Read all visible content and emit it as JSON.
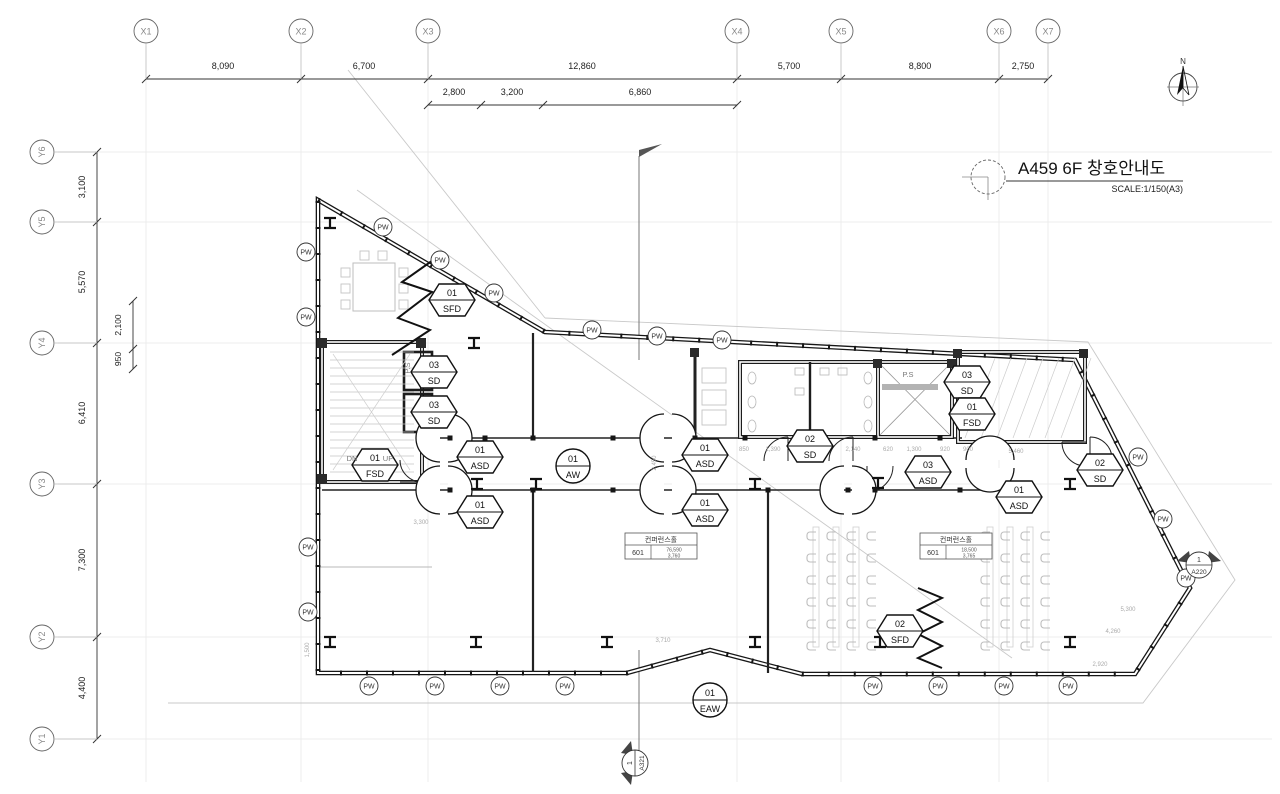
{
  "title": {
    "text": "A459 6F 창호안내도",
    "scale": "SCALE:1/150(A3)"
  },
  "north": {
    "label": "N"
  },
  "grid": {
    "x_markers": [
      {
        "label": "X1",
        "x": 146
      },
      {
        "label": "X2",
        "x": 301
      },
      {
        "label": "X3",
        "x": 428
      },
      {
        "label": "X4",
        "x": 737
      },
      {
        "label": "X5",
        "x": 841
      },
      {
        "label": "X6",
        "x": 999
      },
      {
        "label": "X7",
        "x": 1048
      }
    ],
    "x_dims": [
      {
        "label": "8,090",
        "x": 223
      },
      {
        "label": "6,700",
        "x": 364
      },
      {
        "label": "12,860",
        "x": 582
      },
      {
        "label": "5,700",
        "x": 789
      },
      {
        "label": "8,800",
        "x": 920
      },
      {
        "label": "2,750",
        "x": 1023
      }
    ],
    "x_subdims": [
      {
        "label": "2,800",
        "x": 454
      },
      {
        "label": "3,200",
        "x": 512
      },
      {
        "label": "6,860",
        "x": 640
      }
    ],
    "x_subticks": [
      428,
      481,
      543,
      737
    ],
    "y_markers": [
      {
        "label": "Y6",
        "y": 152
      },
      {
        "label": "Y5",
        "y": 222
      },
      {
        "label": "Y4",
        "y": 343
      },
      {
        "label": "Y3",
        "y": 484
      },
      {
        "label": "Y2",
        "y": 637
      },
      {
        "label": "Y1",
        "y": 739
      }
    ],
    "y_dims": [
      {
        "label": "3,100",
        "y": 187
      },
      {
        "label": "5,570",
        "y": 282
      },
      {
        "label": "6,410",
        "y": 413
      },
      {
        "label": "7,300",
        "y": 560
      },
      {
        "label": "4,400",
        "y": 688
      }
    ],
    "y_subdims": [
      {
        "label": "2,100",
        "y": 325
      },
      {
        "label": "950",
        "y": 359
      }
    ],
    "y_subticks": [
      301,
      349,
      369
    ]
  },
  "hex_tags": [
    {
      "num": "01",
      "code": "SFD",
      "x": 452,
      "y": 300
    },
    {
      "num": "03",
      "code": "SD",
      "x": 434,
      "y": 372
    },
    {
      "num": "03",
      "code": "SD",
      "x": 434,
      "y": 412
    },
    {
      "num": "01",
      "code": "FSD",
      "x": 375,
      "y": 465
    },
    {
      "num": "01",
      "code": "ASD",
      "x": 480,
      "y": 457
    },
    {
      "num": "01",
      "code": "ASD",
      "x": 480,
      "y": 512
    },
    {
      "num": "01",
      "code": "ASD",
      "x": 705,
      "y": 455
    },
    {
      "num": "01",
      "code": "ASD",
      "x": 705,
      "y": 510
    },
    {
      "num": "02",
      "code": "SD",
      "x": 810,
      "y": 446
    },
    {
      "num": "03",
      "code": "ASD",
      "x": 928,
      "y": 472
    },
    {
      "num": "03",
      "code": "SD",
      "x": 967,
      "y": 382
    },
    {
      "num": "01",
      "code": "FSD",
      "x": 972,
      "y": 414
    },
    {
      "num": "02",
      "code": "SD",
      "x": 1100,
      "y": 470
    },
    {
      "num": "01",
      "code": "ASD",
      "x": 1019,
      "y": 497
    },
    {
      "num": "02",
      "code": "SFD",
      "x": 900,
      "y": 631
    }
  ],
  "circle_tags": [
    {
      "num": "01",
      "code": "AW",
      "x": 573,
      "y": 466
    },
    {
      "num": "01",
      "code": "EAW",
      "x": 710,
      "y": 700
    }
  ],
  "pw": {
    "label": "PW",
    "positions": [
      {
        "x": 306,
        "y": 252
      },
      {
        "x": 306,
        "y": 317
      },
      {
        "x": 308,
        "y": 547
      },
      {
        "x": 308,
        "y": 612
      },
      {
        "x": 383,
        "y": 227
      },
      {
        "x": 440,
        "y": 260
      },
      {
        "x": 494,
        "y": 293
      },
      {
        "x": 592,
        "y": 330
      },
      {
        "x": 657,
        "y": 336
      },
      {
        "x": 722,
        "y": 340
      },
      {
        "x": 1138,
        "y": 457
      },
      {
        "x": 1163,
        "y": 519
      },
      {
        "x": 1186,
        "y": 578
      },
      {
        "x": 369,
        "y": 686
      },
      {
        "x": 435,
        "y": 686
      },
      {
        "x": 500,
        "y": 686
      },
      {
        "x": 565,
        "y": 686
      },
      {
        "x": 873,
        "y": 686
      },
      {
        "x": 938,
        "y": 686
      },
      {
        "x": 1004,
        "y": 686
      },
      {
        "x": 1068,
        "y": 686
      }
    ]
  },
  "plan_labels": [
    {
      "text": "DN",
      "x": 352,
      "y": 461,
      "rot": 0
    },
    {
      "text": "UP",
      "x": 388,
      "y": 461,
      "rot": 0
    },
    {
      "text": "P.S",
      "x": 410,
      "y": 368,
      "rot": -90
    },
    {
      "text": "P.S",
      "x": 908,
      "y": 377,
      "rot": 0
    }
  ],
  "room_tags": [
    {
      "name": "컨퍼런스홀",
      "no": "601",
      "v1": "76,590",
      "v2": "3,760",
      "x": 625,
      "y": 533
    },
    {
      "name": "컨퍼런스홀",
      "no": "601",
      "v1": "18,500",
      "v2": "3,765",
      "x": 920,
      "y": 533
    }
  ],
  "section_markers": [
    {
      "num": "1",
      "ref": "A220",
      "x": 1199,
      "y": 565,
      "rot": 0
    },
    {
      "num": "1",
      "ref": "A321",
      "x": 635,
      "y": 763,
      "rot": -90
    }
  ],
  "tiny_dims": [
    {
      "t": "850",
      "x": 744,
      "y": 451,
      "rot": 0
    },
    {
      "t": "1,390",
      "x": 773,
      "y": 451,
      "rot": 0
    },
    {
      "t": "2,140",
      "x": 853,
      "y": 451,
      "rot": 0
    },
    {
      "t": "620",
      "x": 888,
      "y": 451,
      "rot": 0
    },
    {
      "t": "1,300",
      "x": 914,
      "y": 451,
      "rot": 0
    },
    {
      "t": "920",
      "x": 945,
      "y": 451,
      "rot": 0
    },
    {
      "t": "900",
      "x": 968,
      "y": 451,
      "rot": 0
    },
    {
      "t": "5,460",
      "x": 1016,
      "y": 453,
      "rot": 0
    },
    {
      "t": "5,300",
      "x": 1128,
      "y": 611,
      "rot": 0
    },
    {
      "t": "4,260",
      "x": 1113,
      "y": 633,
      "rot": 0
    },
    {
      "t": "2,920",
      "x": 1100,
      "y": 666,
      "rot": 0
    },
    {
      "t": "3,710",
      "x": 663,
      "y": 642,
      "rot": 0
    },
    {
      "t": "3,300",
      "x": 421,
      "y": 524,
      "rot": 0
    },
    {
      "t": "2,450",
      "x": 656,
      "y": 463,
      "rot": -90
    },
    {
      "t": "1,500",
      "x": 309,
      "y": 650,
      "rot": -90
    }
  ]
}
